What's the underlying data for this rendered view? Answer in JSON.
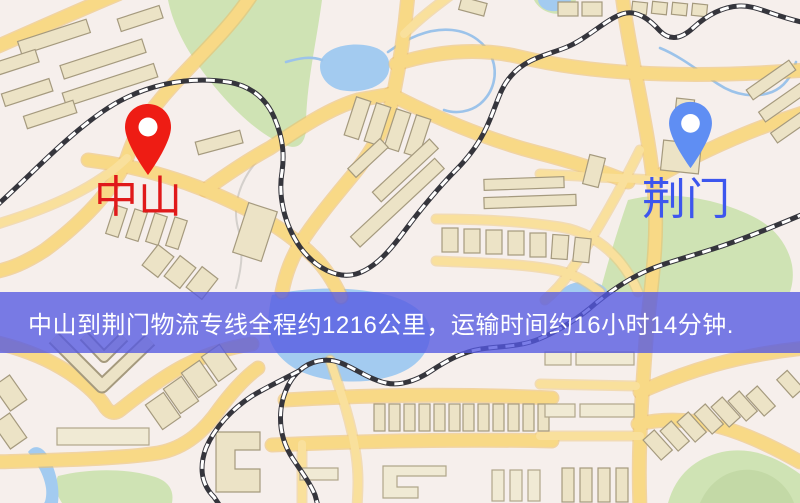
{
  "banner": {
    "text": "中山到荆门物流专线全程约1216公里，运输时间约16小时14分钟.",
    "distance_text": "约1216公里",
    "duration_text": "约16小时14分钟",
    "background_color": "#5458e2",
    "text_color": "#ffffff"
  },
  "markers": {
    "origin": {
      "label": "中山",
      "pin_color": "#ee1c14",
      "label_color": "#e0191a"
    },
    "destination": {
      "label": "荆门",
      "pin_color": "#5f8ef3",
      "label_color": "#3d56ee"
    }
  },
  "map_palette": {
    "background": "#f6efec",
    "road": "#f8d986",
    "road_casing": "#edbe66",
    "water": "#a3cbf0",
    "park": "#cfe3b4",
    "building": "#ece3c6",
    "railway": "#35353c"
  }
}
